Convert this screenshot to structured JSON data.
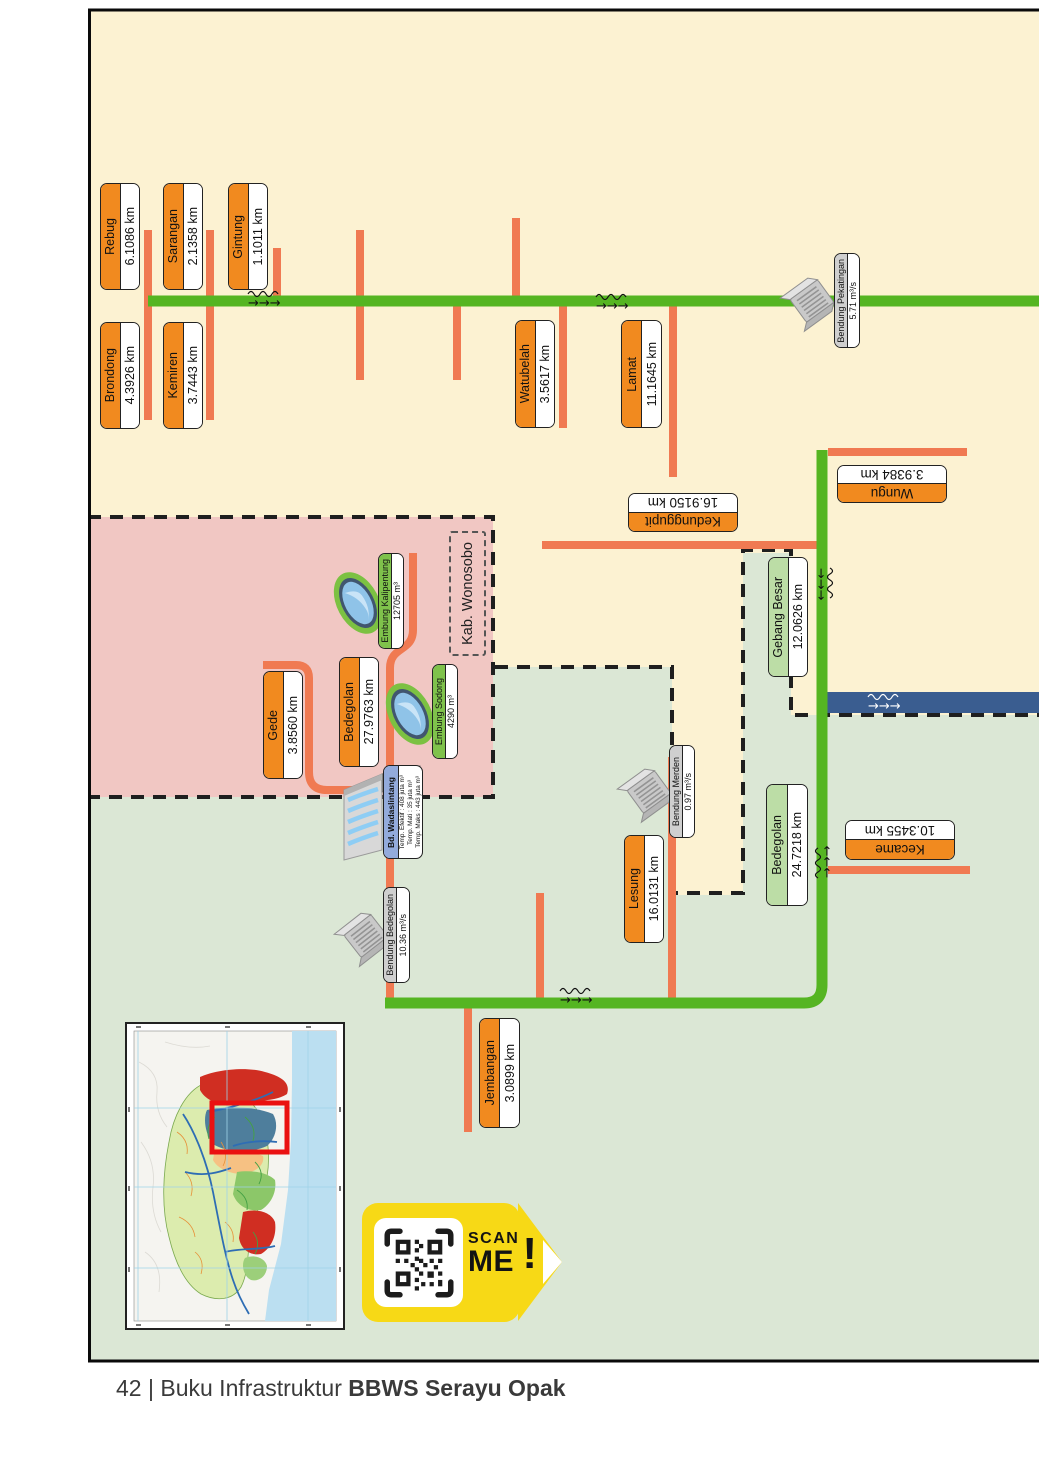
{
  "footer": {
    "page_number": "42",
    "separator": "|",
    "title_regular": "Buku Infrastruktur",
    "title_bold": "BBWS Serayu Opak"
  },
  "regions": {
    "wonosobo_label": "Kab. Wonosobo"
  },
  "labels": {
    "rebug": {
      "name": "Rebug",
      "value": "6.1086 km"
    },
    "sarangan": {
      "name": "Sarangan",
      "value": "2.1358 km"
    },
    "gintung": {
      "name": "Gintung",
      "value": "1.1011 km"
    },
    "brondong": {
      "name": "Brondong",
      "value": "4.3926 km"
    },
    "kemiren": {
      "name": "Kemiren",
      "value": "3.7443 km"
    },
    "watubelah": {
      "name": "Watubelah",
      "value": "3.5617 km"
    },
    "lamat": {
      "name": "Lamat",
      "value": "11.1645 km"
    },
    "wungu": {
      "name": "Wungu",
      "value": "3.9384 km"
    },
    "kedunggupit": {
      "name": "Kedunggupit",
      "value": "16.9150 km"
    },
    "gebang_besar": {
      "name": "Gebang Besar",
      "value": "12.0626 km"
    },
    "gede": {
      "name": "Gede",
      "value": "3.8560 km"
    },
    "bedegolan_u": {
      "name": "Bedegolan",
      "value": "27.9763 km"
    },
    "kalipentung": {
      "name": "Embung Kalipentung",
      "value": "12705 m³"
    },
    "sodong": {
      "name": "Embung Sodong",
      "value": "4290 m³"
    },
    "pekatingan": {
      "name": "Bendung Pekatingan",
      "value": "5.71 m³/s"
    },
    "bendung_bedegolan": {
      "name": "Bendung Bedegolan",
      "value": "10.36 m³/s"
    },
    "merden": {
      "name": "Bendung Merden",
      "value": "0.97 m³/s"
    },
    "lesung": {
      "name": "Lesung",
      "value": "16.0131 km"
    },
    "bedegolan_l": {
      "name": "Bedegolan",
      "value": "24.7218 km"
    },
    "kecame": {
      "name": "Kecame",
      "value": "10.3455 km"
    },
    "jembangan": {
      "name": "Jembangan",
      "value": "3.0899 km"
    }
  },
  "wadaslintang": {
    "title": "Bd. Wadaslintang",
    "lines": [
      "Temp. Efektif : 408 juta m³",
      "Temp. Mati : 35 juta m³",
      "Temp. Maks : 443 juta m³"
    ]
  },
  "scan_badge": {
    "line1": "SCAN",
    "line2": "ME",
    "exclaim": "!"
  },
  "colors": {
    "cream": "#FCF2D2",
    "pink": "#F1C7C3",
    "sage": "#DBE7D5",
    "river_green": "#55B522",
    "river_orange": "#F07A52",
    "label_orange": "#F18A1F",
    "label_green_dark": "#7FC24B",
    "label_green_light": "#BCDDA6",
    "label_gray": "#CFCFCF",
    "label_blue": "#93ABDC",
    "canal_blue": "#3A5D90",
    "badge_yellow": "#F7D916"
  }
}
